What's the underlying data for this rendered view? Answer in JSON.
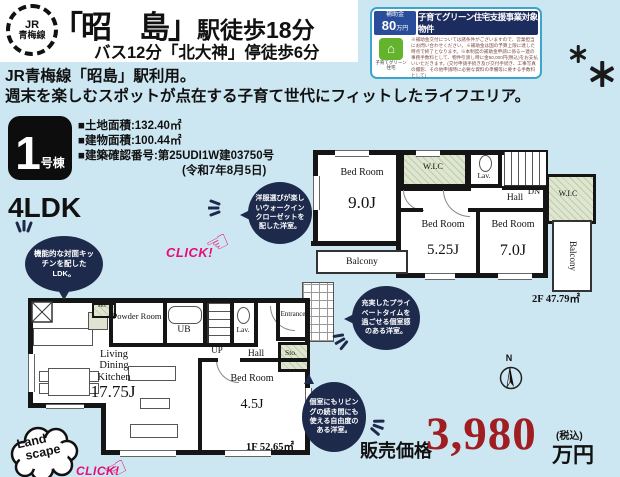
{
  "header": {
    "line_badge_top": "JR",
    "line_badge_bottom": "青梅線",
    "station_name": "「昭　島」",
    "station_walk": "駅徒歩18分",
    "bus_access": "バス12分「北大神」停徒歩6分",
    "rail_usage": "JR青梅線「昭島」駅利用。",
    "catch_copy": "週末を楽しむスポットが点在する子育て世代にフィットしたライフエリア。"
  },
  "subsidy": {
    "label": "補助金",
    "amount": "80",
    "amount_unit": "万円",
    "banner": "子育てグリーン住宅支援事業対象物件",
    "icon_label": "子育てグリーン住宅",
    "icon_glyph": "⌂",
    "disclaimer": "※補助金交付については諸条件がございますので、営業担当にお問い合わせください。※補助金は国の予算上限に達した時点で終了となります。※本制度の補助金申請に係る一連の事務手数料として、物件引渡し時に金50,000円(税込)をお支払いいただきます。(交付申請手続き及び交付手続き、工事写真の撮影、その他申請時に必要な資料の準備等に要する手数料として)"
  },
  "property": {
    "building_no": "1",
    "building_no_suffix": "号棟",
    "land_area": "■土地面積:132.40㎡",
    "building_area": "■建物面積:100.44㎡",
    "confirmation_no": "■建築確認番号:第25UDI1W建03750号",
    "confirmation_date": "(令和7年8月5日)",
    "layout": "4LDK"
  },
  "bubbles": {
    "kitchen": "機能的な対面キッチンを配したLDK。",
    "wic": "洋服選びが楽しいウォークインクローゼットを配した洋室。",
    "private": "充実したプライベートタイムを過ごせる個室感のある洋室。",
    "free": "個室にもリビングの続き間にも使える自由度のある洋室。"
  },
  "click_label": "CLICK!",
  "landscape": {
    "line1": "Land",
    "line2": "scape"
  },
  "compass": "N",
  "plan1f": {
    "floor_label": "1F 52.65㎡",
    "ldk_name": "Living Dining Kitchen",
    "ldk_size": "17.75J",
    "bed_name": "Bed Room",
    "bed_size": "4.5J",
    "powder": "Powder Room",
    "ub": "UB",
    "lav": "Lav.",
    "up": "UP",
    "hall": "Hall",
    "sto_a": "Sto.",
    "sto_b": "Sto.",
    "entrance": "Entrance"
  },
  "plan2f": {
    "floor_label": "2F 47.79㎡",
    "bed1_name": "Bed Room",
    "bed1_size": "9.0J",
    "bed2_name": "Bed Room",
    "bed2_size": "5.25J",
    "bed3_name": "Bed Room",
    "bed3_size": "7.0J",
    "wic_a": "W.I.C",
    "wic_b": "W.I.C",
    "lav": "Lav.",
    "hall": "Hall",
    "dn": "DN",
    "balcony_a": "Balcony",
    "balcony_b": "Balcony"
  },
  "price": {
    "label": "販売価格",
    "amount": "3,980",
    "tax_note": "(税込)",
    "unit": "万円"
  }
}
